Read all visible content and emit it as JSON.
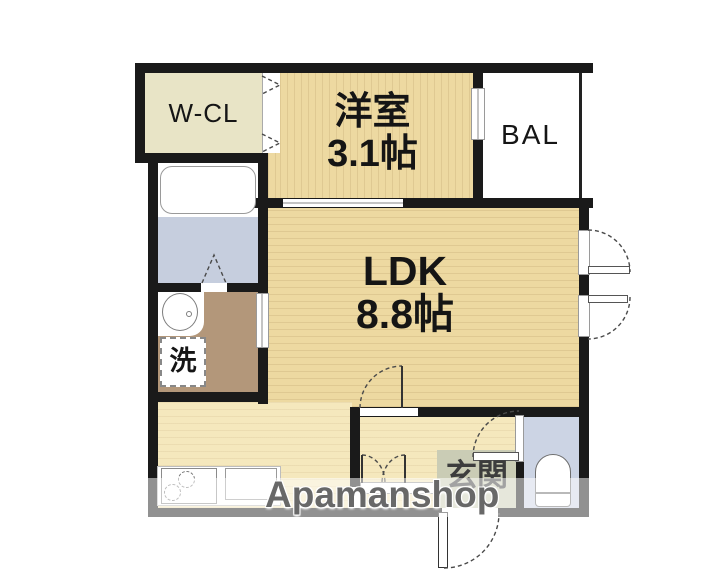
{
  "watermark": {
    "text": "Apamanshop"
  },
  "rooms": {
    "walk_in_closet": {
      "label": "W-CL"
    },
    "bedroom": {
      "name": "洋室",
      "size": "3.1帖"
    },
    "balcony": {
      "label": "BAL"
    },
    "ldk": {
      "name": "LDK",
      "size": "8.8帖"
    },
    "laundry": {
      "label": "洗"
    },
    "entrance": {
      "label": "玄関"
    }
  },
  "icons": [
    "bathtub-icon",
    "wash-basin-icon",
    "washing-machine-icon",
    "stove-icon",
    "kitchen-sink-icon",
    "toilet-icon",
    "shoe-cabinet-icon",
    "door-arc-icon",
    "folding-door-icon",
    "closet-door-chevron-icon",
    "window-icon",
    "sliding-door-icon"
  ],
  "colors": {
    "wall": "#1a1a1a",
    "wcl_floor": "#e8e4c6",
    "wood_main": "#edd9a1",
    "wood_light": "#f5e8bd",
    "bath_floor": "#c6cede",
    "toilet_floor": "#ccd4e4",
    "washroom_floor": "#b3977a",
    "entrance_floor": "#caccb5",
    "watermark_gray": "#686868"
  }
}
